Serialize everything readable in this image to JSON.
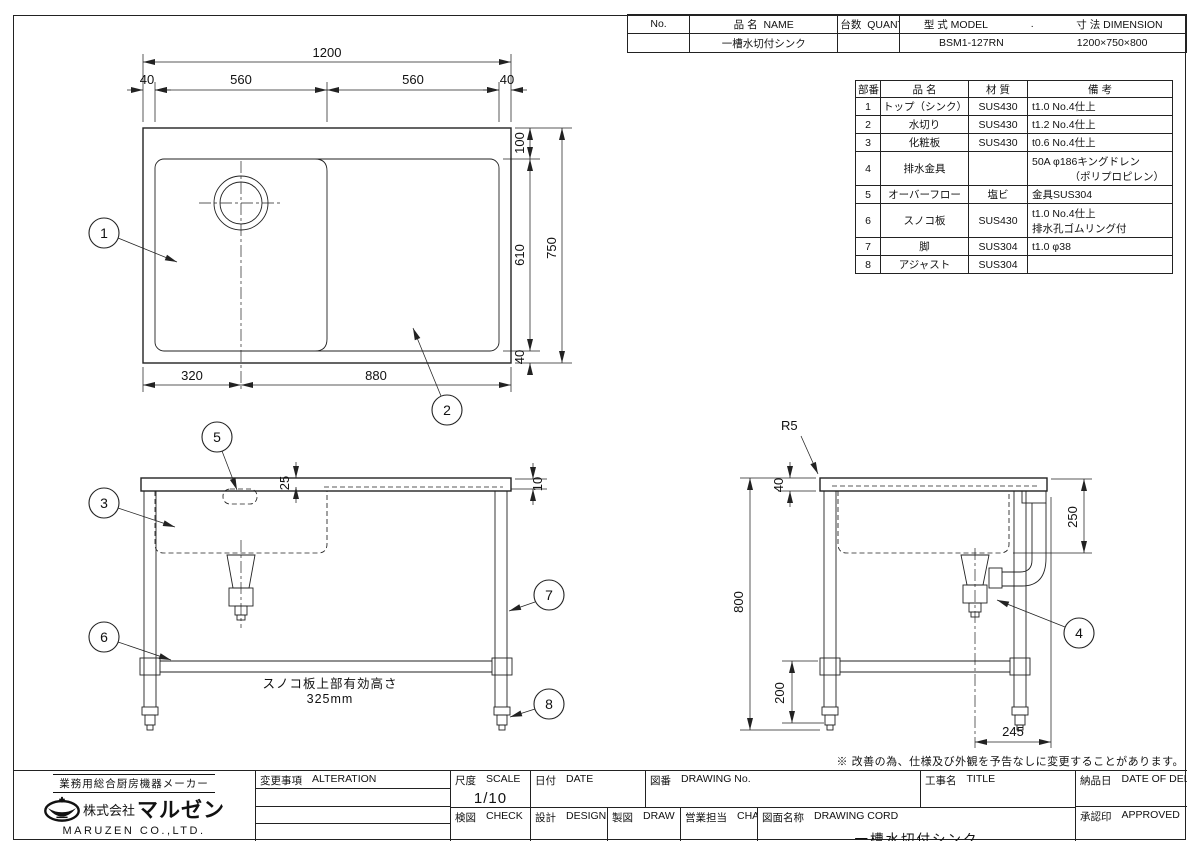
{
  "header_table": {
    "col_no": "No.",
    "col_name": {
      "jp": "品 名",
      "en": "NAME"
    },
    "col_qty": {
      "jp": "台数",
      "en": "QUANTITY"
    },
    "col_model": {
      "jp": "型 式",
      "en": "MODEL"
    },
    "col_dot": ".",
    "col_dim": {
      "jp": "寸 法",
      "en": "DIMENSION"
    },
    "row": {
      "name": "一槽水切付シンク",
      "model": "BSM1-127RN",
      "dimension": "1200×750×800"
    }
  },
  "parts_table": {
    "h_no": "部番",
    "h_name": "品 名",
    "h_material": "材 質",
    "h_note": "備 考",
    "rows": [
      {
        "no": "1",
        "name": "トップ（シンク）",
        "material": "SUS430",
        "note1": "t1.0 No.4仕上",
        "note2": ""
      },
      {
        "no": "2",
        "name": "水切り",
        "material": "SUS430",
        "note1": "t1.2 No.4仕上",
        "note2": ""
      },
      {
        "no": "3",
        "name": "化粧板",
        "material": "SUS430",
        "note1": "t0.6 No.4仕上",
        "note2": ""
      },
      {
        "no": "4",
        "name": "排水金具",
        "material": "",
        "note1": "50A φ186キングドレン",
        "note2": "（ポリプロピレン）"
      },
      {
        "no": "5",
        "name": "オーバーフロー",
        "material": "塩ビ",
        "note1": "金具SUS304",
        "note2": ""
      },
      {
        "no": "6",
        "name": "スノコ板",
        "material": "SUS430",
        "note1": "t1.0 No.4仕上",
        "note2": "排水孔ゴムリング付"
      },
      {
        "no": "7",
        "name": "脚",
        "material": "SUS304",
        "note1": "t1.0 φ38",
        "note2": ""
      },
      {
        "no": "8",
        "name": "アジャスト",
        "material": "SUS304",
        "note1": "",
        "note2": ""
      }
    ]
  },
  "dims": {
    "top_view": {
      "overall_w": "1200",
      "m_left": "40",
      "w_bowl": "560",
      "w_drain": "560",
      "m_right": "40",
      "m_top": "100",
      "h_inner": "610",
      "overall_d": "750",
      "m_bottom": "40",
      "x_drain": "320",
      "w_rest": "880"
    },
    "front_view": {
      "d_backguard": "25",
      "d_edge": "10"
    },
    "side_view": {
      "r_corner": "R5",
      "t_top": "40",
      "d_bowl": "250",
      "h_overall": "800",
      "h_shelf": "200",
      "x_drain": "245"
    }
  },
  "balloons": {
    "b1": "1",
    "b2": "2",
    "b3": "3",
    "b4": "4",
    "b5": "5",
    "b6": "6",
    "b7": "7",
    "b8": "8"
  },
  "notes": {
    "shelf_line1": "スノコ板上部有効高さ",
    "shelf_line2": "325mm",
    "disclaimer": "※ 改善の為、仕様及び外観を予告なしに変更することがあります。"
  },
  "title_block": {
    "alteration": {
      "jp": "変更事項",
      "en": "ALTERATION"
    },
    "scale": {
      "jp": "尺度",
      "en": "SCALE"
    },
    "scale_value": "1/10",
    "date": {
      "jp": "日付",
      "en": "DATE"
    },
    "drawing_no": {
      "jp": "図番",
      "en": "DRAWING No."
    },
    "title": {
      "jp": "工事名",
      "en": "TITLE"
    },
    "check": {
      "jp": "検図",
      "en": "CHECK"
    },
    "design": {
      "jp": "設計",
      "en": "DESIGN"
    },
    "draw": {
      "jp": "製図",
      "en": "DRAW"
    },
    "charge": {
      "jp": "営業担当",
      "en": "CHARGE"
    },
    "drawing_cord": {
      "jp": "図面名称",
      "en": "DRAWING CORD"
    },
    "drawing_cord_value": "一槽水切付シンク",
    "delivery": {
      "jp": "納品日",
      "en": "DATE OF DELIVERY"
    },
    "approved": {
      "jp": "承認印",
      "en": "APPROVED"
    }
  },
  "company": {
    "tagline": "業務用総合厨房機器メーカー",
    "name_prefix": "株式会社",
    "name": "マルゼン",
    "name_en": "MARUZEN CO.,LTD."
  }
}
